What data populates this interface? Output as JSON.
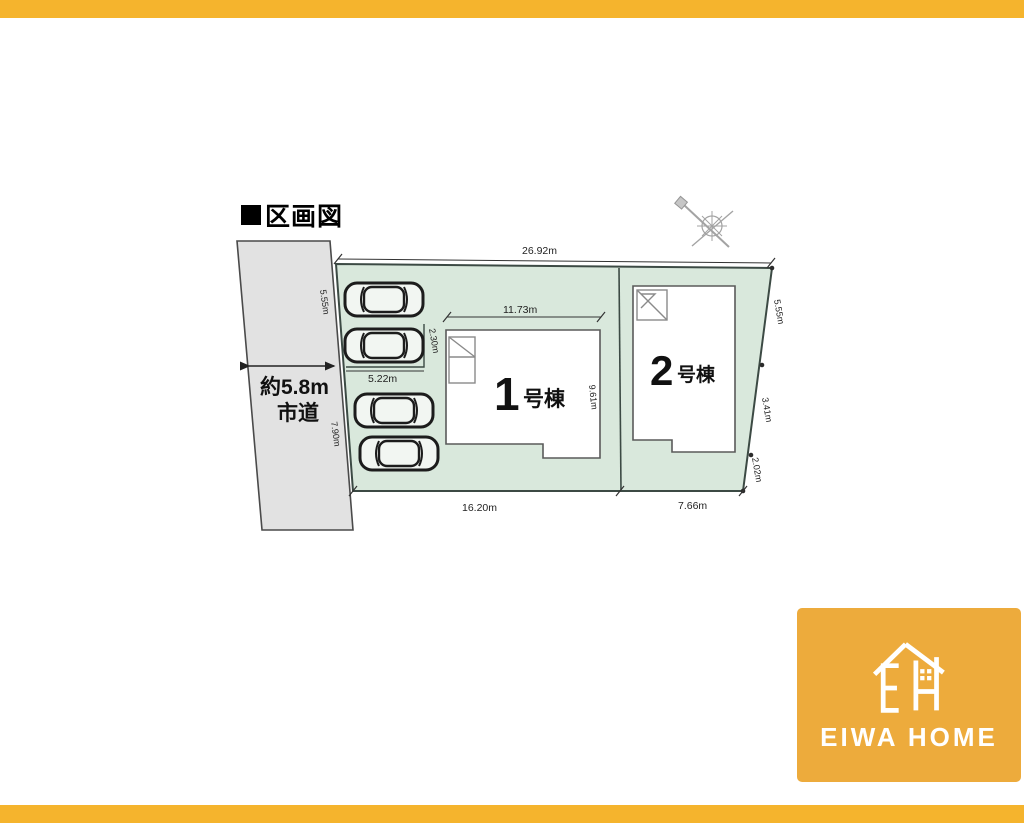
{
  "colors": {
    "bar_orange": "#F5B42D",
    "logo_orange": "#EDAB3C",
    "plot_green": "#D9E8DC",
    "road_gray": "#E2E2E2"
  },
  "header": {
    "title": "区画図"
  },
  "plan": {
    "road": {
      "width_label": "約5.8m",
      "type_label": "市道"
    },
    "dims": {
      "top": "26.92m",
      "bottom_left": "16.20m",
      "bottom_right": "7.66m",
      "left_upper": "5.55m",
      "left_lower": "7.90m",
      "right_upper": "5.55m",
      "right_middle": "3.41m",
      "right_lower": "2.02m",
      "b1_top": "11.73m",
      "b1_side": "9.61m",
      "carport_width": "5.22m",
      "carport_depth": "2.30m"
    },
    "buildings": [
      {
        "number": "1",
        "suffix": "号棟"
      },
      {
        "number": "2",
        "suffix": "号棟"
      }
    ],
    "cars_count": 4
  },
  "logo": {
    "brand": "EIWA HOME"
  }
}
